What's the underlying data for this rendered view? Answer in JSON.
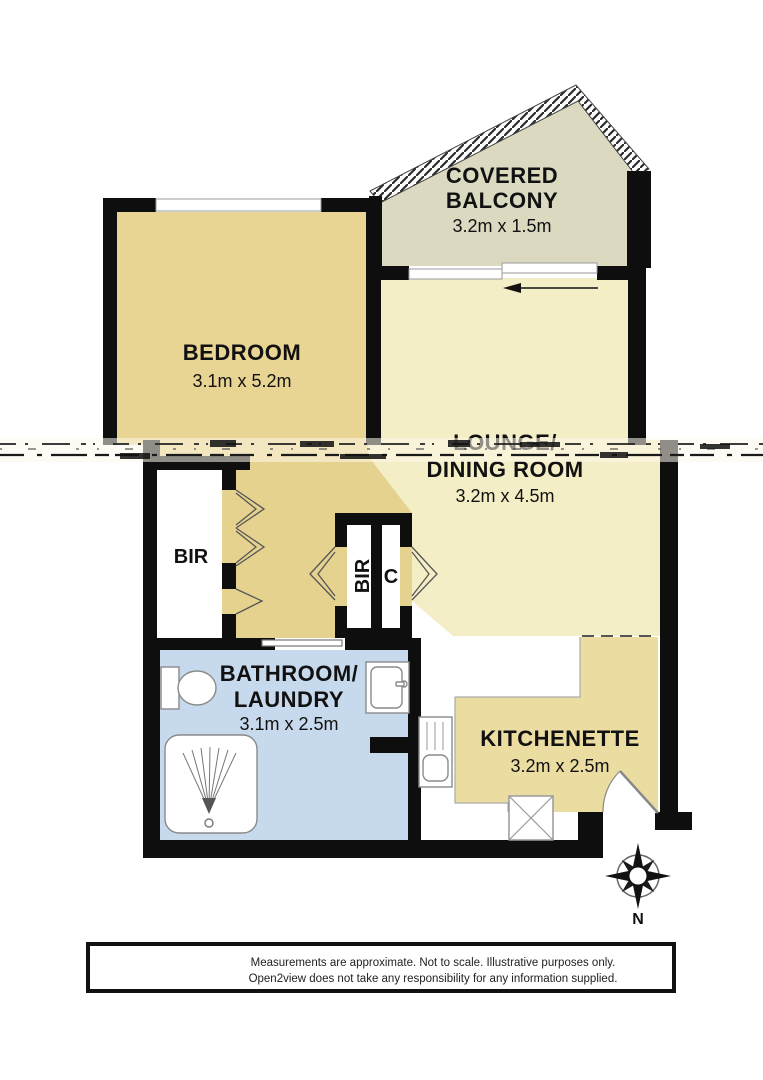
{
  "plan_title": "Apartment floor plan",
  "rooms": {
    "balcony": {
      "name_line1": "COVERED",
      "name_line2": "BALCONY",
      "dims": "3.2m x 1.5m"
    },
    "bedroom": {
      "name": "BEDROOM",
      "dims": "3.1m x 5.2m"
    },
    "lounge": {
      "name_line1": "LOUNGE/",
      "name_line2": "DINING ROOM",
      "dims": "3.2m x 4.5m"
    },
    "bathroom": {
      "name_line1": "BATHROOM/",
      "name_line2": "LAUNDRY",
      "dims": "3.1m x 2.5m"
    },
    "kitchenette": {
      "name": "KITCHENETTE",
      "dims": "3.2m x 2.5m"
    },
    "bir_left": {
      "label": "BIR"
    },
    "bir_middle": {
      "label": "BIR"
    },
    "closet": {
      "label": "C"
    }
  },
  "compass": {
    "north_label": "N"
  },
  "disclaimer": {
    "line1": "Measurements are approximate. Not to scale. Illustrative purposes only.",
    "line2": "Open2view does not take any responsibility for any information supplied."
  },
  "colors": {
    "wall": "#0e0e0e",
    "bedroom_fill": "#e9d593",
    "hall_fill": "#e6d28f",
    "lounge_fill": "#f3eec5",
    "kitchenette_fill": "#ebdca2",
    "balcony_fill": "#dbdac1",
    "bathroom_fill": "#c7d9ec",
    "fixture_stroke": "#8a8a8a"
  },
  "icons": {
    "compass": "compass-rose-icon",
    "toilet": "toilet-icon",
    "vanity": "sink-icon",
    "shower": "shower-icon",
    "kitchen_sink": "kitchen-sink-icon",
    "crossed_box": "crossed-box-icon",
    "door": "door-swing-icon",
    "slider_arrow": "sliding-door-arrow-icon"
  }
}
